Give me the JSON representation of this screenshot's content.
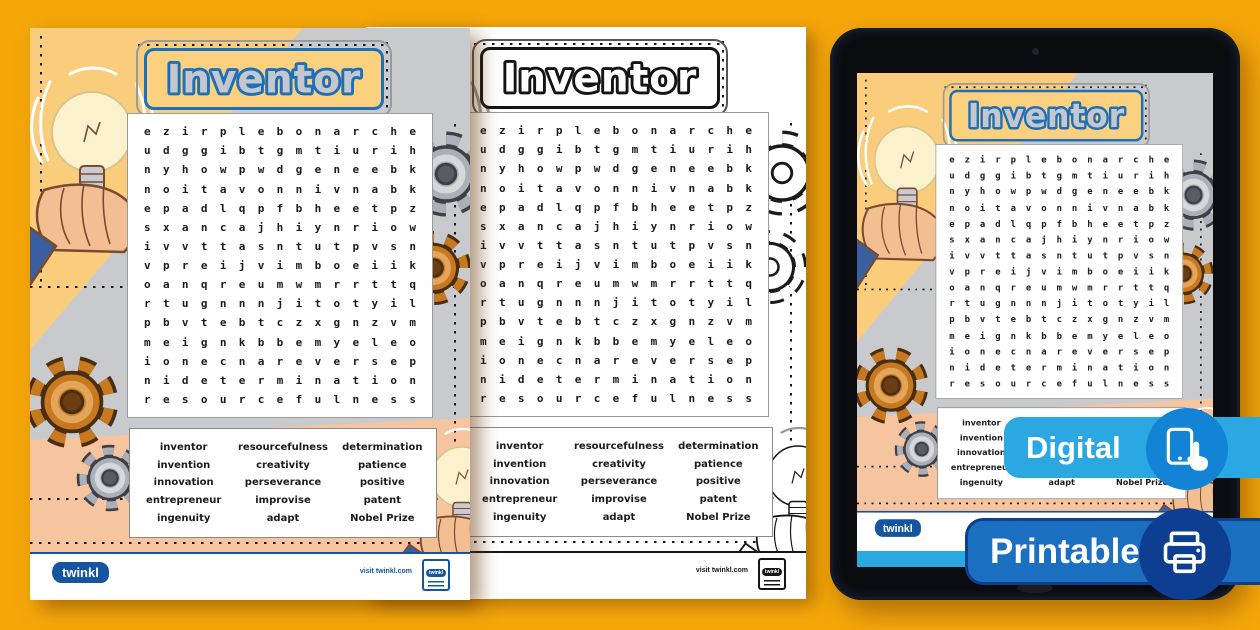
{
  "worksheet": {
    "title": "Inventor",
    "grid_rows": [
      "ezirplebonarche",
      "udggibtgmtiurih",
      "nyhowpwdgeneebk",
      "noitavonnivnabk",
      "epadlqpfbheetpz",
      "sxancajhiynriow",
      "ivvttasntutpvsn",
      "vpreijvimboeiik",
      "oanqreumwmrrttq",
      "rtugnnnjitotyil",
      "pbvtebtczxgnzvm",
      "meignkbbemyeleo",
      "ionecnareversep",
      "nidetermination",
      "resourcefulness"
    ],
    "words": {
      "col1": [
        "inventor",
        "invention",
        "innovation",
        "entrepreneur",
        "ingenuity"
      ],
      "col2": [
        "resourcefulness",
        "creativity",
        "perseverance",
        "improvise",
        "adapt"
      ],
      "col3": [
        "determination",
        "patience",
        "positive",
        "patent",
        "Nobel Prize"
      ]
    },
    "footer": {
      "brand": "twinkl",
      "visit": "visit twinkl.com"
    }
  },
  "badges": {
    "digital": {
      "label": "Digital",
      "icon": "tablet-touch-icon",
      "bar_color": "#2BA7E2",
      "circle_color": "#1383D6"
    },
    "printable": {
      "label": "Printable",
      "icon": "printer-icon",
      "bar_color": "#1B6FC1",
      "circle_color": "#0D3E8F"
    }
  },
  "colors": {
    "background_orange": "#F5A70A",
    "page_yellow": "#FACD7C",
    "page_grey": "#C9CACD",
    "page_peach": "#F6C5A0",
    "title_border_blue": "#1D6FB8",
    "title_letter_grey": "#C5C7CC",
    "footer_blue": "#15549E",
    "tablet_strip_blue": "#2AA9E1",
    "gear_orange": "#C8791F",
    "gear_grey": "#ACB0B6"
  }
}
